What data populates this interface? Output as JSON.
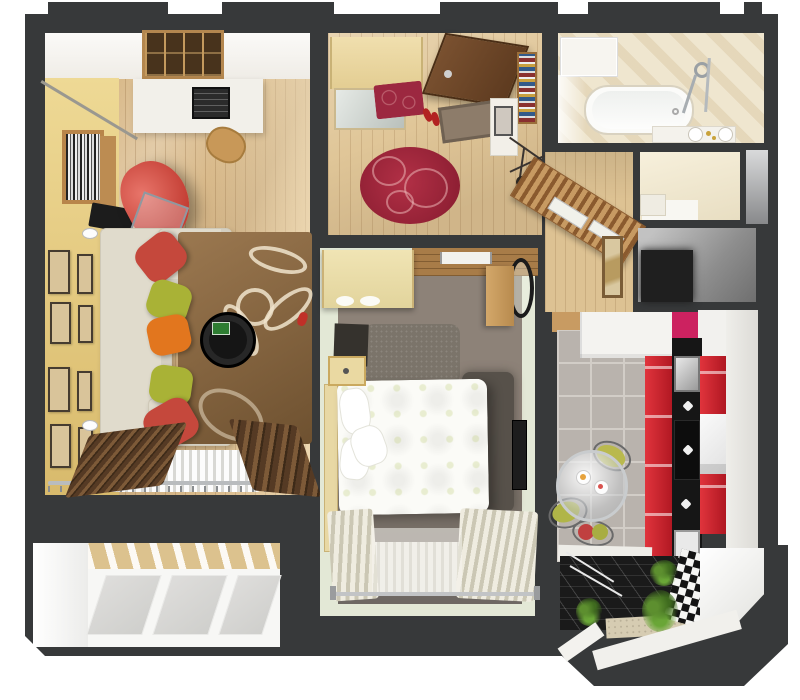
{
  "scene": {
    "kind": "3d-rendered apartment floor plan, top-down view",
    "canvas": {
      "width": 800,
      "height": 700
    }
  },
  "palette": {
    "wall": "#37393a",
    "background": "#ffffff",
    "wood_floor": "#d9ba8b",
    "yellow_wall": "#e8d48a",
    "rug_brown": "#8a6a42",
    "sofa": "#e0dbcc",
    "pillow_red": "#c5483c",
    "pillow_green": "#a9b236",
    "pillow_orange": "#e2761e",
    "armchair_red": "#d0544a",
    "hall_rug_red": "#9c2840",
    "kitchen_red": "#cc2333",
    "kitchen_magenta": "#cc2260",
    "tile_gray": "#b9b3ad",
    "bathroom_cream": "#efe6cf",
    "bedroom_wall_green": "#e3e8d6",
    "bedroom_floor": "#8d8278",
    "balcony_dark": "#1a1a1a",
    "plant_green": "#5d8f2f"
  },
  "rooms": [
    {
      "id": "living-room",
      "position": "top-left",
      "features": [
        "wood floor",
        "yellow accent wall",
        "cube shelving",
        "white desk with printer",
        "wooden chair",
        "bookshelf",
        "red armchair",
        "glass side table",
        "black tv",
        "white corner sofa",
        "red-green-orange pillows",
        "brown floral rug",
        "round black coffee table",
        "eight wall frames",
        "radiator",
        "dark brown curtains",
        "curtain rod"
      ]
    },
    {
      "id": "hallway",
      "position": "top-center",
      "features": [
        "entrance door",
        "wardrobe with mirror",
        "red patterned bench",
        "doormat",
        "red shoes",
        "red oval rug",
        "book shelf",
        "white dresser with picture",
        "coat stand"
      ]
    },
    {
      "id": "corridor",
      "position": "center",
      "features": [
        "wood floor",
        "diagonal slatted wardrobe with white doors",
        "framed picture"
      ]
    },
    {
      "id": "bathroom",
      "position": "top-right",
      "features": [
        "cream diagonal tiles",
        "white cabinet",
        "bathtub",
        "shower set",
        "vanity with two basins"
      ]
    },
    {
      "id": "wc",
      "position": "right",
      "features": [
        "cream walls",
        "white cabinet"
      ]
    },
    {
      "id": "shaft",
      "position": "right",
      "features": [
        "gray niche"
      ]
    },
    {
      "id": "storage-room",
      "position": "right",
      "features": [
        "gray walls",
        "dark floor"
      ]
    },
    {
      "id": "bedroom",
      "position": "center-bottom",
      "features": [
        "pale green walls",
        "taupe carpet",
        "light wood wardrobe",
        "wood entry strip",
        "round mirror",
        "wood dresser",
        "gray shag rug",
        "tv cabinet",
        "double bed with floral duvet",
        "two nightstands",
        "wall tv",
        "radiator",
        "cream curtains",
        "curtain rod"
      ]
    },
    {
      "id": "kitchen",
      "position": "bottom-right",
      "features": [
        "gray tile floor",
        "white upper cabinets",
        "magenta accent",
        "red cabinet run",
        "black countertop",
        "steel sink",
        "hob",
        "white tall unit",
        "round glass dining table",
        "wire chairs with olive cushions",
        "plates with food"
      ]
    },
    {
      "id": "kitchen-balcony",
      "position": "bottom-right bay",
      "features": [
        "dark glossy floor",
        "white railing reflections",
        "green plants",
        "black-white checker strip",
        "white ledge",
        "beveled bay corner"
      ]
    },
    {
      "id": "balcony",
      "position": "bottom-left",
      "features": [
        "white walls",
        "wood band with slats",
        "three gray floor panels"
      ]
    }
  ],
  "structure": {
    "outer_walls": "thick charcoal walls, beveled bottom-right bay and bottom-left corner",
    "top_tabs": 5
  }
}
